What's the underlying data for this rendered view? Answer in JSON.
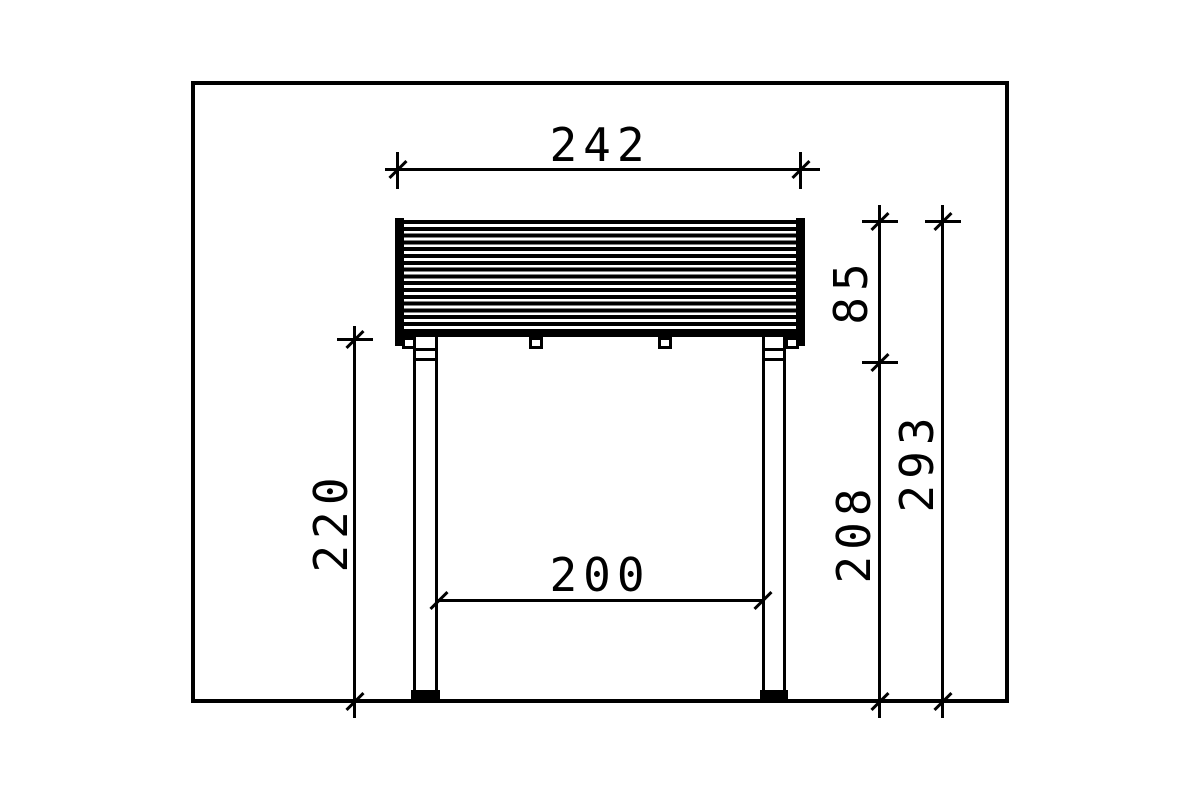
{
  "drawing": {
    "title": "canopy-side-elevation",
    "dimensions": {
      "roof_width": "242",
      "roof_height": "85",
      "post_height": "220",
      "span_between_posts": "200",
      "clearance_height": "208",
      "overall_height": "293"
    },
    "colors": {
      "line": "#000000",
      "background": "#ffffff"
    }
  }
}
